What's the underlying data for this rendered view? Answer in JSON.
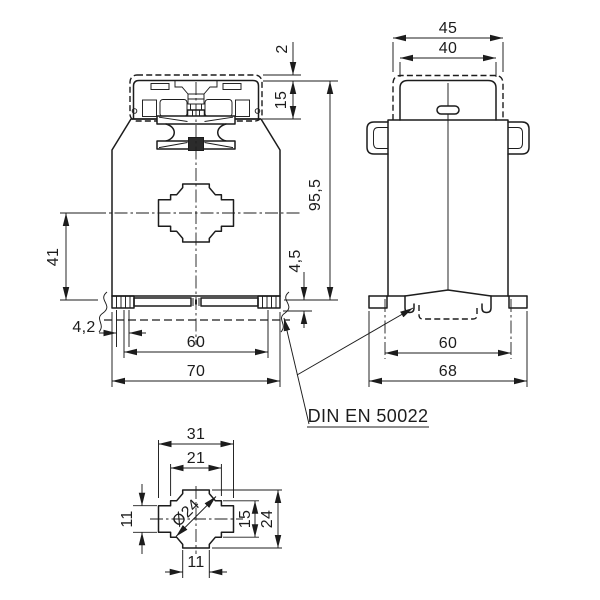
{
  "drawing": {
    "title": "DIN rail current transformer dimensional drawing",
    "front_view": {
      "dims": {
        "cover_offset": "2",
        "terminal_height": "15",
        "total_height": "95,5",
        "clip_depth": "4,5",
        "center_height": "41",
        "lip_width": "4,2",
        "rail_span": "60",
        "overall_width": "70"
      }
    },
    "side_view": {
      "dims": {
        "cap_outer_width": "45",
        "cap_inner_width": "40",
        "rail_span": "60",
        "base_width": "68"
      }
    },
    "detail_view": {
      "dims": {
        "outer_width": "31",
        "inner_width": "21",
        "bore_diameter": "Ø24",
        "arm_height": "11",
        "inner_height": "15",
        "outer_height": "24",
        "arm_width": "11"
      }
    },
    "note": {
      "standard": "DIN EN 50022"
    }
  }
}
